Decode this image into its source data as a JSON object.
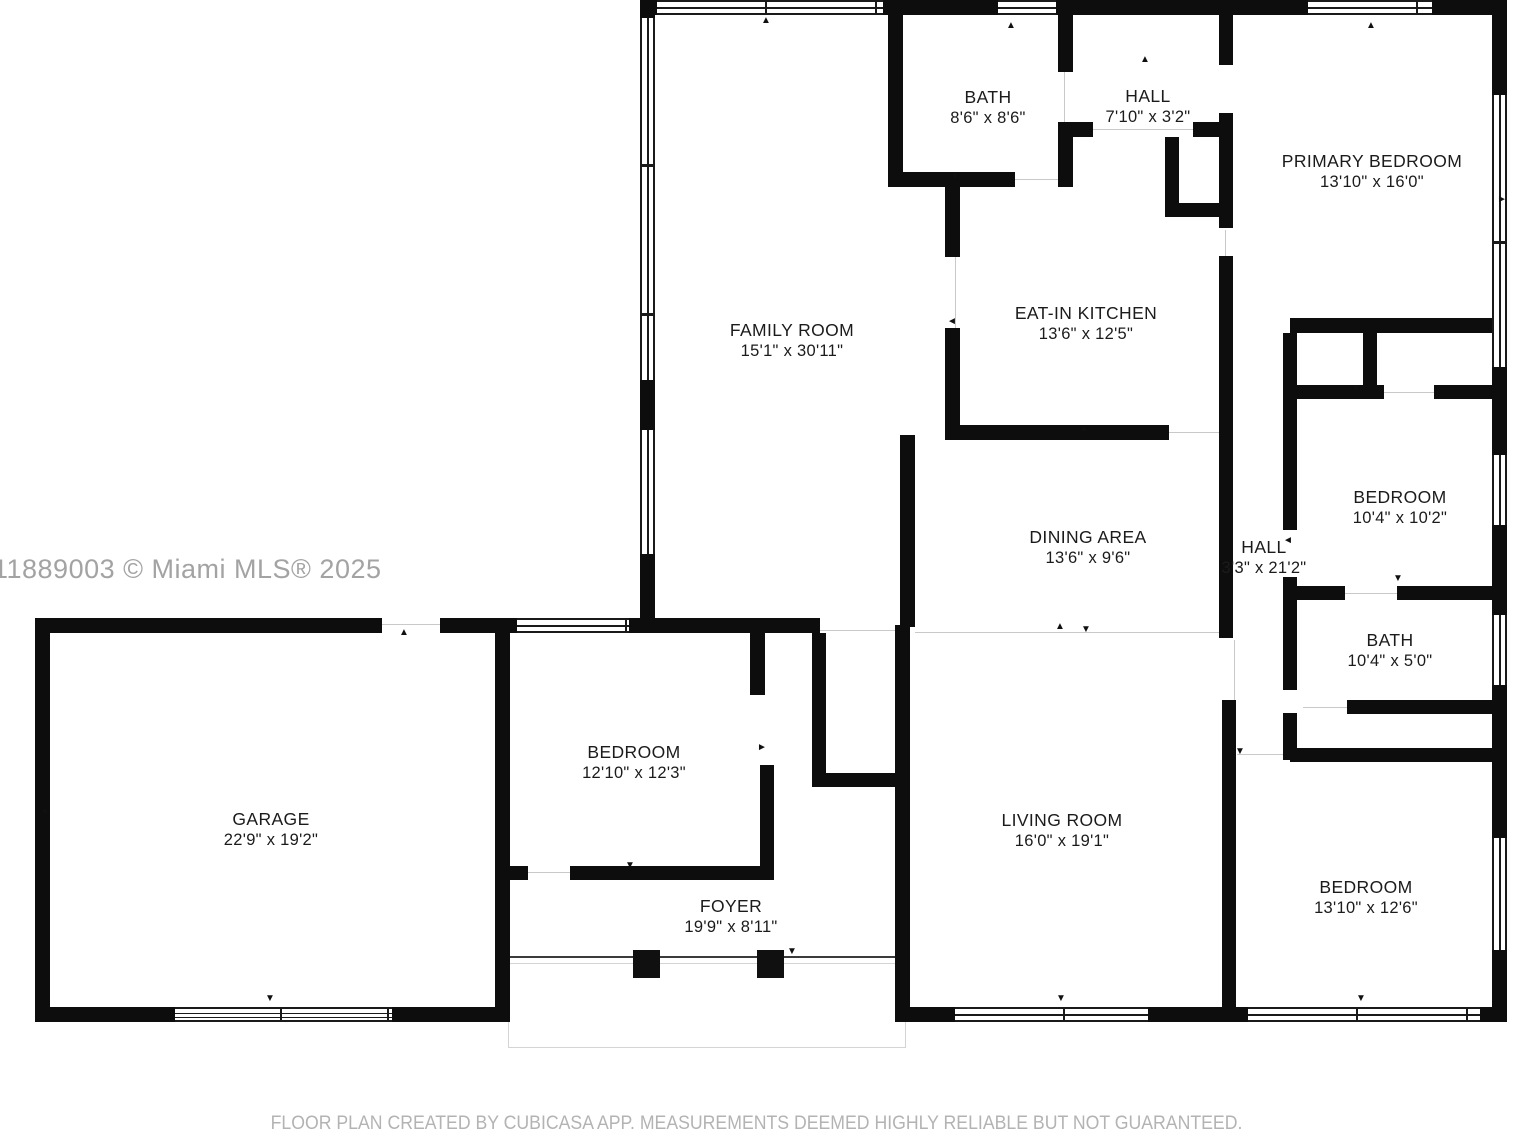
{
  "watermark": "11889003 © Miami MLS® 2025",
  "footer": "FLOOR PLAN CREATED BY CUBICASA APP. MEASUREMENTS DEEMED HIGHLY RELIABLE BUT NOT GUARANTEED.",
  "colors": {
    "wall": "#0d0d0d",
    "label": "#1b1b1b",
    "muted": "#a3a3a3",
    "footer": "#b3b3b3"
  },
  "rooms": [
    {
      "id": "family-room",
      "name": "FAMILY ROOM",
      "dims": "15'1\" x 30'11\""
    },
    {
      "id": "bath-top",
      "name": "BATH",
      "dims": "8'6\" x 8'6\""
    },
    {
      "id": "hall-top",
      "name": "HALL",
      "dims": "7'10\" x 3'2\""
    },
    {
      "id": "primary-bedroom",
      "name": "PRIMARY BEDROOM",
      "dims": "13'10\" x 16'0\""
    },
    {
      "id": "eat-in-kitchen",
      "name": "EAT-IN KITCHEN",
      "dims": "13'6\" x 12'5\""
    },
    {
      "id": "dining-area",
      "name": "DINING AREA",
      "dims": "13'6\" x 9'6\""
    },
    {
      "id": "bedroom-right",
      "name": "BEDROOM",
      "dims": "10'4\" x 10'2\""
    },
    {
      "id": "hall-right",
      "name": "HALL",
      "dims": "3'3\" x 21'2\""
    },
    {
      "id": "bath-right",
      "name": "BATH",
      "dims": "10'4\" x 5'0\""
    },
    {
      "id": "bedroom-bottom-right",
      "name": "BEDROOM",
      "dims": "13'10\" x 12'6\""
    },
    {
      "id": "living-room",
      "name": "LIVING ROOM",
      "dims": "16'0\" x 19'1\""
    },
    {
      "id": "garage",
      "name": "GARAGE",
      "dims": "22'9\" x 19'2\""
    },
    {
      "id": "bedroom-middle",
      "name": "BEDROOM",
      "dims": "12'10\" x 12'3\""
    },
    {
      "id": "foyer",
      "name": "FOYER",
      "dims": "19'9\" x 8'11\""
    }
  ]
}
